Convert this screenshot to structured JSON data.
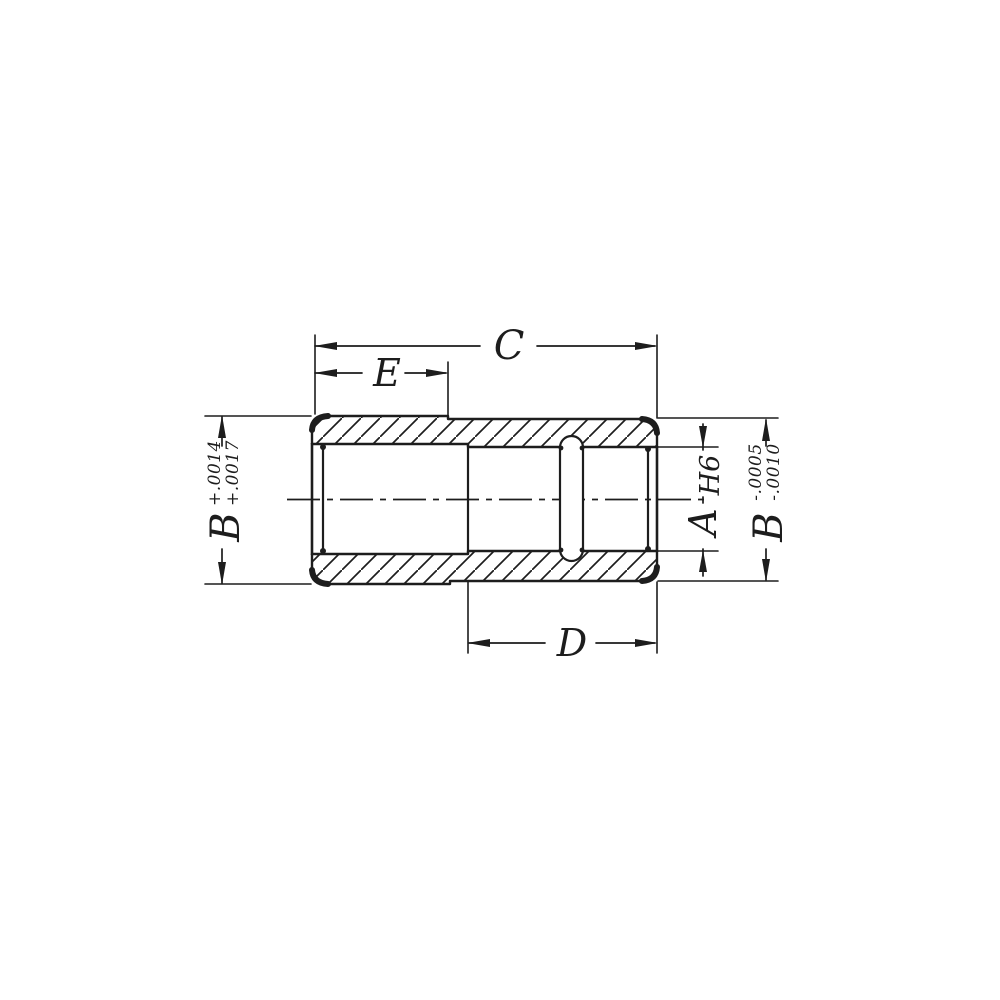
{
  "colors": {
    "ink": "#1d1d1d",
    "background": "#ffffff"
  },
  "drawing": {
    "kind": "sectional technical drawing of a stepped bushing sleeve with cross slot",
    "labels": {
      "length_overall": "C",
      "length_left_section": "E",
      "length_right_section": "D",
      "bore_diameter": "A",
      "bore_fit": "H6",
      "od_left": "B",
      "od_left_tol_line1": "+.0014",
      "od_left_tol_line2": "+.0017",
      "od_right": "B",
      "od_right_tol_line1": "-.0005",
      "od_right_tol_line2": "-.0010"
    }
  }
}
